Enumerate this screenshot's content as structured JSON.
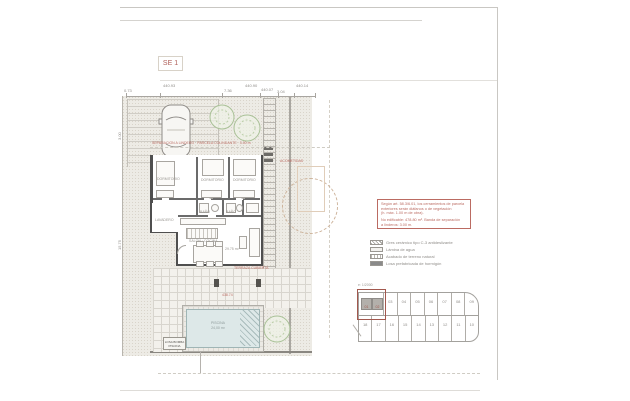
{
  "sheet": {
    "label": "SE 1"
  },
  "dims": {
    "top": [
      "0.73",
      "440.93",
      "7.36",
      "440.90",
      "440.07",
      "3.04",
      "440.14"
    ],
    "left": [
      "3.00",
      "15.75"
    ]
  },
  "plan": {
    "red_boundary_note": "SEPARACION A LINDERO · PARCELA COLINDANTE · 3.00 m",
    "red_acometida": "ACOMETIDAS",
    "red_terraza": "TERRAZA CUBIERTA",
    "red_level": "438.74",
    "rooms": {
      "bedroom1": "DORMITORIO",
      "bedroom2": "DORMITORIO",
      "bedroom3": "DORMITORIO",
      "bath1": "BAÑO",
      "bath2": "BAÑO",
      "laundry": "LAVADERO",
      "living": "SALON · COCINA",
      "living_area": "29.75 m²"
    },
    "pool": {
      "label": "PISCINA",
      "area": "24,00 m²"
    },
    "pump_box": [
      "LOSA BOMBA",
      "PISCINA"
    ]
  },
  "note_box": {
    "lines": [
      "Según art. 58.3/6.01, los cerramientos de parcela",
      "exteriores serán diáfanos o de vegetación",
      "(h. máx. 1.00 m de obra).",
      "No edificable: 478.80 m². Banda de separación",
      "a linderos: 3.00 m."
    ]
  },
  "legend": {
    "items": [
      "Gres cerámico tipo C-3 antideslizante",
      "Lámina de agua",
      "Acabado de terreno natural",
      "Losa prefabricada de hormigón"
    ]
  },
  "siteplan": {
    "scale": "e: 1/2000",
    "highlight": [
      "01",
      "02"
    ],
    "top": [
      "03",
      "04",
      "05",
      "06",
      "07",
      "08",
      "09"
    ],
    "bottom": [
      "18",
      "17",
      "16",
      "15",
      "14",
      "13",
      "12",
      "11",
      "10"
    ]
  },
  "colors": {
    "accent_red": "#bb6b62",
    "wall": "#4f4f4f",
    "water": "#dde8e8"
  }
}
